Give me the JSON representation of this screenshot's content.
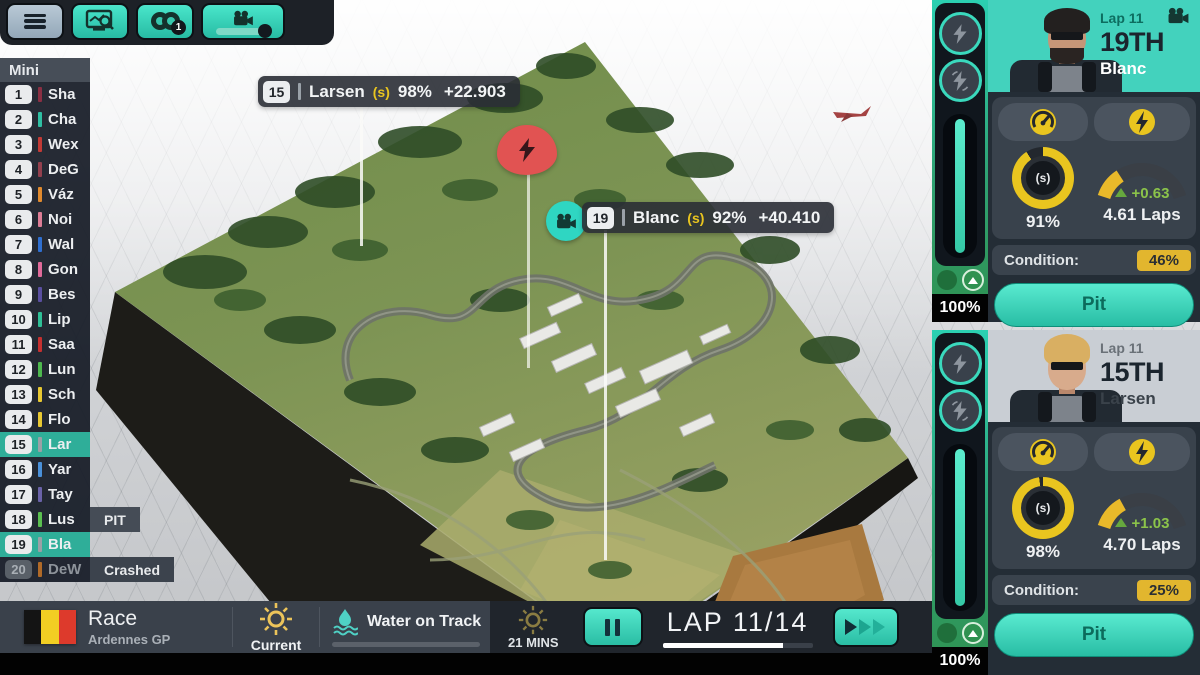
{
  "colors": {
    "accent": "#3fd9c0",
    "highlight": "#2fae99",
    "badge_yellow": "#e2b62e",
    "incident_red": "#e15352",
    "flag_black": "#141414",
    "flag_yellow": "#f2ce23",
    "flag_red": "#dd3a2c"
  },
  "toolbar": {
    "tyres_badge": "1"
  },
  "standings": {
    "title": "Mini",
    "rows": [
      {
        "pos": "1",
        "name": "Sha",
        "color": "#8a2f43"
      },
      {
        "pos": "2",
        "name": "Cha",
        "color": "#2fbfa3"
      },
      {
        "pos": "3",
        "name": "Wex",
        "color": "#c23a36"
      },
      {
        "pos": "4",
        "name": "DeG",
        "color": "#93404e"
      },
      {
        "pos": "5",
        "name": "Váz",
        "color": "#e08a2e"
      },
      {
        "pos": "6",
        "name": "Noi",
        "color": "#dd7d96"
      },
      {
        "pos": "7",
        "name": "Wal",
        "color": "#2f6fd0"
      },
      {
        "pos": "8",
        "name": "Gon",
        "color": "#e06a9a"
      },
      {
        "pos": "9",
        "name": "Bes",
        "color": "#5a4fa0"
      },
      {
        "pos": "10",
        "name": "Lip",
        "color": "#2fbf96"
      },
      {
        "pos": "11",
        "name": "Saa",
        "color": "#c53030"
      },
      {
        "pos": "12",
        "name": "Lun",
        "color": "#4db84e"
      },
      {
        "pos": "13",
        "name": "Sch",
        "color": "#e8c832"
      },
      {
        "pos": "14",
        "name": "Flo",
        "color": "#e8c832"
      },
      {
        "pos": "15",
        "name": "Lar",
        "color": "#9aa0a6",
        "highlight": true
      },
      {
        "pos": "16",
        "name": "Yar",
        "color": "#4a90d9"
      },
      {
        "pos": "17",
        "name": "Tay",
        "color": "#6a62a8"
      },
      {
        "pos": "18",
        "name": "Lus",
        "color": "#5abf50",
        "status": "PIT"
      },
      {
        "pos": "19",
        "name": "Bla",
        "color": "#9aa0a6",
        "highlight": true
      },
      {
        "pos": "20",
        "name": "DeW",
        "color": "#b06a28",
        "status": "Crashed",
        "dim": true
      }
    ]
  },
  "map_overlay": {
    "drivers": [
      {
        "pos": "15",
        "name": "Larsen",
        "tyre": "(s)",
        "tyre_pct": "98%",
        "gap": "+22.903"
      },
      {
        "pos": "19",
        "name": "Blanc",
        "tyre": "(s)",
        "tyre_pct": "92%",
        "gap": "+40.410"
      }
    ]
  },
  "bottom_bar": {
    "session": "Race",
    "event": "Ardennes GP",
    "weather_now": "Current",
    "water": "Water on Track",
    "forecast": "21 MINS",
    "lap": "LAP 11/14",
    "lap_progress": "80%"
  },
  "panels": [
    {
      "lap": "Lap 11",
      "position": "19TH",
      "name": "Blanc",
      "header_bg": "#43d2bd",
      "name_color": "#ffffff",
      "lap_color": "#0d6e60",
      "tyre_compound": "(s)",
      "tyre_pct": "91%",
      "fuel_fill": "27 100",
      "fuel_delta": "+0.63",
      "fuel_laps": "4.61 Laps",
      "condition_label": "Condition:",
      "condition": "46%",
      "pit": "Pit",
      "ers": "100%"
    },
    {
      "lap": "Lap 11",
      "position": "15TH",
      "name": "Larsen",
      "header_bg": "#c9ced4",
      "name_color": "#3a424a",
      "lap_color": "#6a7178",
      "tyre_compound": "(s)",
      "tyre_pct": "98%",
      "fuel_fill": "30 100",
      "fuel_delta": "+1.03",
      "fuel_laps": "4.70 Laps",
      "condition_label": "Condition:",
      "condition": "25%",
      "pit": "Pit",
      "ers": "100%"
    }
  ]
}
